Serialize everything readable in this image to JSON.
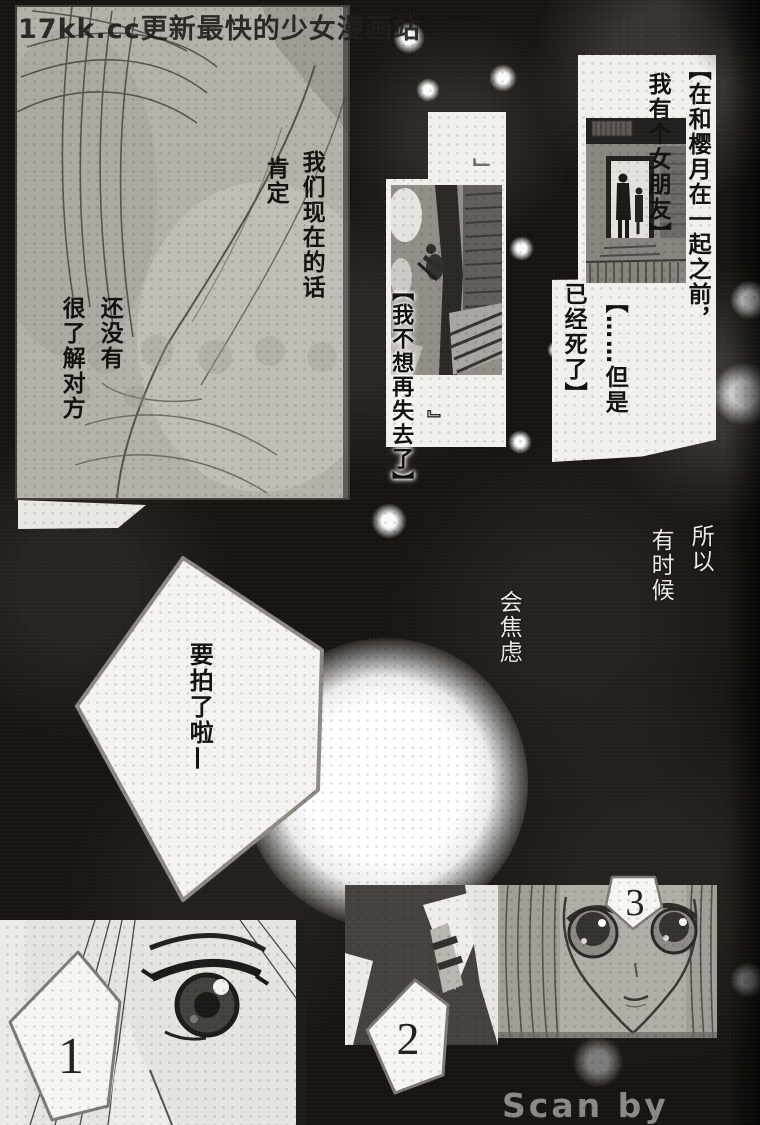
{
  "page": {
    "watermark": "17kk.cc更新最快的少女漫画站",
    "scan_credit": "Scan by Osora"
  },
  "panel_top_left": {
    "dialogue_line1": "我们现在的话",
    "dialogue_line2": "肯定",
    "dialogue_line3": "还没有",
    "dialogue_line4": "很了解对方"
  },
  "flashback": {
    "caption_before": "【在和樱月在一起之前，",
    "caption_girlfriend": "我有个女朋友】",
    "caption_but": "【……但是",
    "caption_died": "已经死了】",
    "caption_lose": "【我不想再失去了】",
    "quote_top": "」",
    "quote_bottom": "』"
  },
  "monologue": {
    "so": "所以",
    "sometimes": "有时候",
    "anxious": "会焦虑"
  },
  "speech_bubble": {
    "text": "要拍了啦—"
  },
  "panel_badges": {
    "one": "1",
    "two": "2",
    "three": "3"
  },
  "colors": {
    "page_bg": "#171411",
    "panel_gray": "#b5b1aa",
    "paper_white": "#f2f0ec",
    "ink": "#13110e",
    "text_white": "#eceae6",
    "credit_gray": "#92908c"
  }
}
